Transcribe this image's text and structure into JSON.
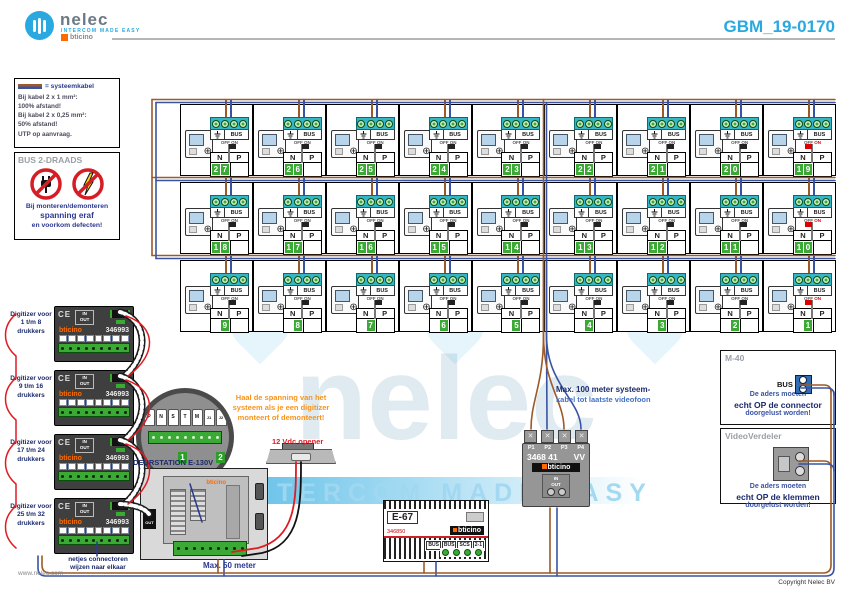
{
  "header": {
    "logo": "nelec",
    "tagline": "INTERCOM MADE EASY",
    "partner": "bticino",
    "title": "GBM_19-0170"
  },
  "legend": {
    "swatch_label": "= systeemkabel",
    "lines": [
      "Bij kabel 2 x 1 mm²:",
      "100% afstand!",
      "Bij kabel 2 x 0,25 mm²:",
      "50% afstand!",
      "UTP op aanvraag."
    ]
  },
  "warning": {
    "title": "BUS 2-DRAADS",
    "lines": [
      "Bij monteren/demonteren",
      "spanning eraf",
      "en voorkom defecten!"
    ]
  },
  "grid": {
    "rows": [
      [
        27,
        26,
        25,
        24,
        23,
        22,
        21,
        20,
        19
      ],
      [
        18,
        17,
        16,
        15,
        14,
        13,
        12,
        11,
        10
      ],
      [
        9,
        8,
        7,
        6,
        5,
        4,
        3,
        2,
        1
      ]
    ],
    "bus": "BUS",
    "off": "OFF",
    "on": "ON",
    "n": "N",
    "p": "P"
  },
  "digitizers": {
    "brand": "bticino",
    "model": "346993",
    "ce": "CE",
    "in": "IN",
    "out": "OUT",
    "items": [
      {
        "label": "Digitizer voor 1 t/m 8 drukkers"
      },
      {
        "label": "Digitizer voor 9 t/m 16 drukkers"
      },
      {
        "label": "Digitizer voor 17 t/m 24 drukkers"
      },
      {
        "label": "Digitizer voor 25 t/m 32 drukkers"
      }
    ]
  },
  "primair": {
    "terminals": [
      "P",
      "N",
      "S",
      "T",
      "M",
      "J1",
      "J2"
    ],
    "tags": [
      "1",
      "2"
    ]
  },
  "orange_note": [
    "Haal de spanning van het",
    "systeem als je een digitizer",
    "monteert of demonteert!"
  ],
  "deurstation": {
    "label": "DEURSTATION E-130V",
    "brand": "bticino",
    "in": "IN",
    "out": "OUT"
  },
  "opener": {
    "label": "12 Vdc opener"
  },
  "distributor": {
    "terminals": [
      "P1",
      "P2",
      "P3",
      "P4"
    ],
    "model": "3468 41",
    "variant": "VV",
    "brand": "bticino",
    "in": "IN",
    "out": "OUT"
  },
  "max100": {
    "line1": "Max. 100 meter systeem-",
    "line2": "kabel tot laatste videofoon"
  },
  "psu": {
    "model": "E-67",
    "code": "346850",
    "brand": "bticino",
    "terms": [
      "BUS",
      "BUS",
      "SCS",
      "2-1"
    ]
  },
  "m40": {
    "title": "M-40",
    "bus": "BUS",
    "lines": [
      "De aders moeten",
      "echt OP de connector",
      "doorgelust worden!"
    ]
  },
  "videoverdeler": {
    "title": "VideoVerdeler",
    "lines": [
      "De aders moeten",
      "echt OP de klemmen",
      "doorgelust worden!"
    ]
  },
  "footer": {
    "site": "www.nelec.com",
    "note": [
      "netjes connectoren",
      "wijzen naar elkaar"
    ],
    "max50": "Max. 50 meter",
    "copyright": "Copyright Nelec BV"
  },
  "watermark": {
    "big": "nelec",
    "sub": "INTERCOM MADE EASY"
  },
  "colors": {
    "accent": "#29a9e0",
    "blue": "#2b3990",
    "wire_brown": "#9c5a28",
    "wire_blue": "#3953a4",
    "green": "#3aaa35",
    "orange": "#f7941d",
    "red": "#e01b22"
  }
}
